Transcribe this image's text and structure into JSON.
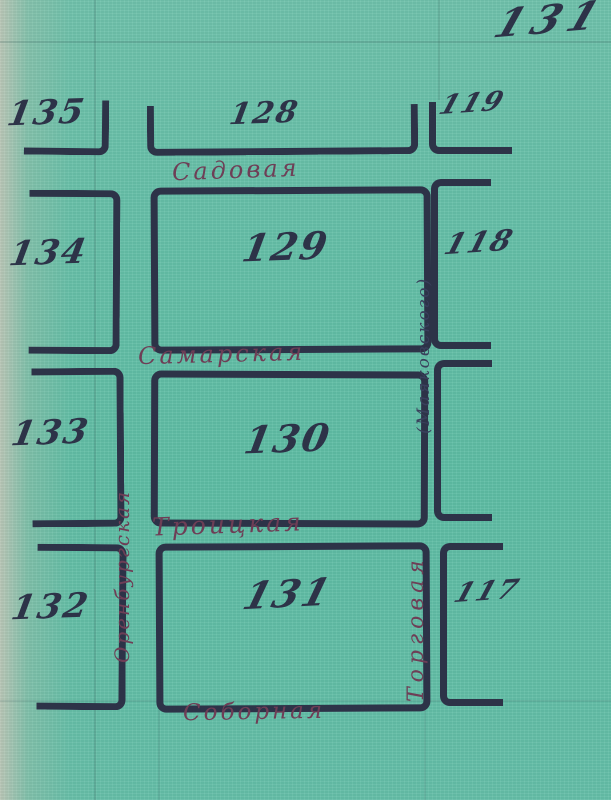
{
  "page": {
    "number": "131"
  },
  "map": {
    "labels": {
      "b135": "135",
      "b128": "128",
      "b119": "119",
      "b134": "134",
      "b129": "129",
      "b118": "118",
      "b133": "133",
      "b130": "130",
      "b132": "132",
      "b131": "131",
      "b117": "117"
    },
    "streets": {
      "sadovaya": "Садовая",
      "samarskaya": "Самарская",
      "troitskaya": "Троицкая",
      "sobornaya": "Соборная",
      "orenburgskaya": "Оренбургская",
      "torgovaya": "Торговая",
      "mayakovskogo": "(Маяковского)"
    }
  },
  "colors": {
    "paper": "#63bfa7",
    "ink": "#2d3348",
    "street_ink": "#6e3e56"
  }
}
